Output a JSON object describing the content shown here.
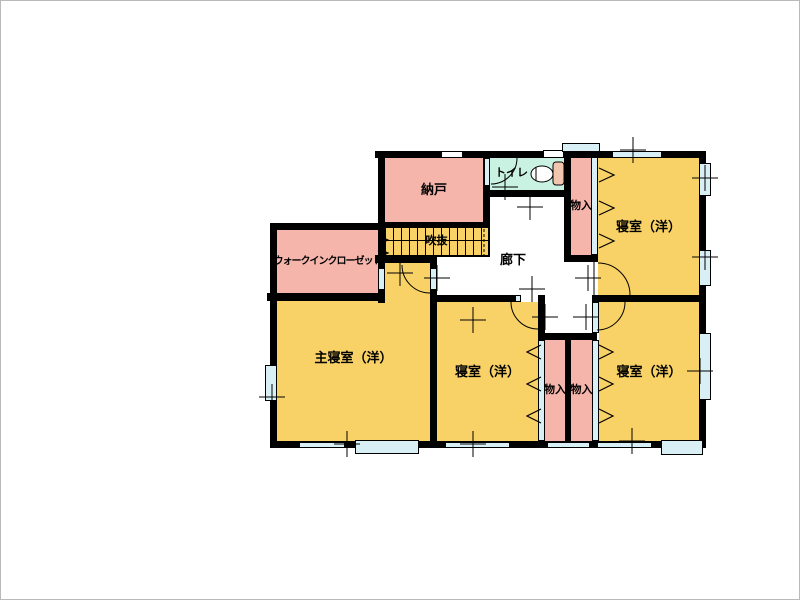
{
  "colors": {
    "room_yellow": "#F8D266",
    "closet_pink": "#F5B5AB",
    "toilet_cyan": "#C9F2E2",
    "window_cyan": "#D8F0F5",
    "wall_black": "#000000",
    "tank_pink": "#F2C5AE"
  },
  "rooms": {
    "nando": {
      "label": "納戸"
    },
    "toilet": {
      "label": "トイレ"
    },
    "closet_top": {
      "label": "物入"
    },
    "bedroom_top_right": {
      "label": "寝室（洋）"
    },
    "walk_in_closet": {
      "label": "ウォークインクローゼット"
    },
    "stair_void": {
      "label": "吹抜"
    },
    "hallway": {
      "label": "廊下"
    },
    "master_bedroom": {
      "label": "主寝室（洋）"
    },
    "bedroom_center": {
      "label": "寝室（洋）"
    },
    "closet_bottom_left": {
      "label": "物入"
    },
    "closet_bottom_right": {
      "label": "物入"
    },
    "bedroom_bottom_right": {
      "label": "寝室（洋）"
    }
  }
}
